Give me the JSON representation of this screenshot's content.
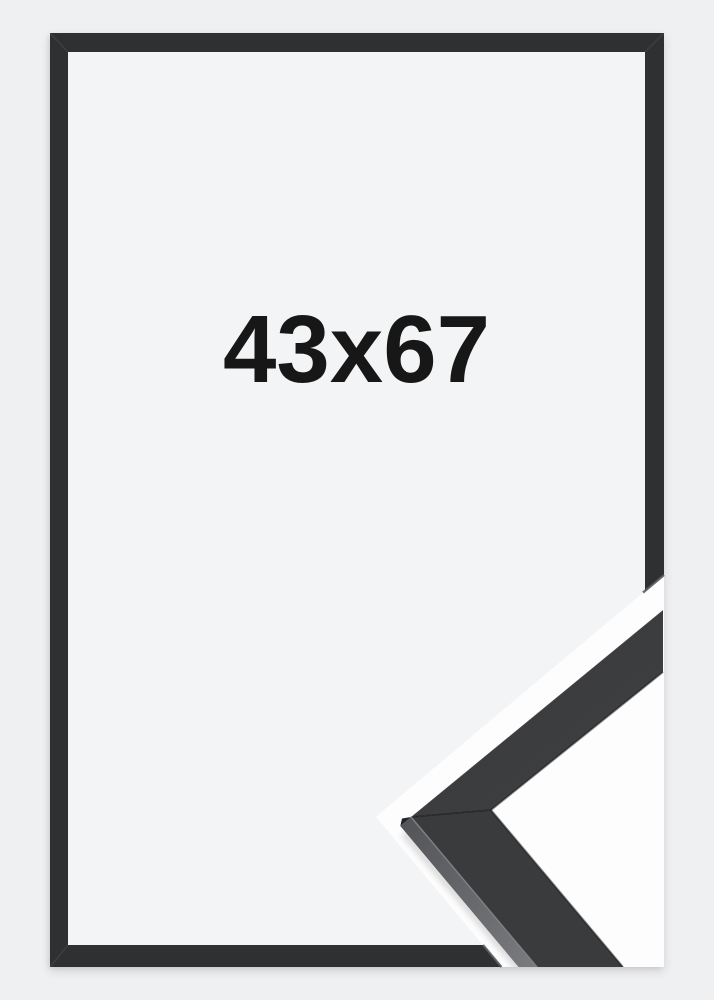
{
  "page": {
    "background_color": "#eff0f1"
  },
  "product_photo": {
    "size_label": "43x67",
    "frame_color": "#2f3031",
    "inner_background": "#f3f4f5",
    "label_color": "#171717"
  },
  "corner_detail_inset": {
    "description_name": "frame-corner-profile-closeup",
    "background": "#fdfdfe",
    "moulding_top_face": "#3c3d3f",
    "moulding_side_face": "#6e6f72"
  }
}
